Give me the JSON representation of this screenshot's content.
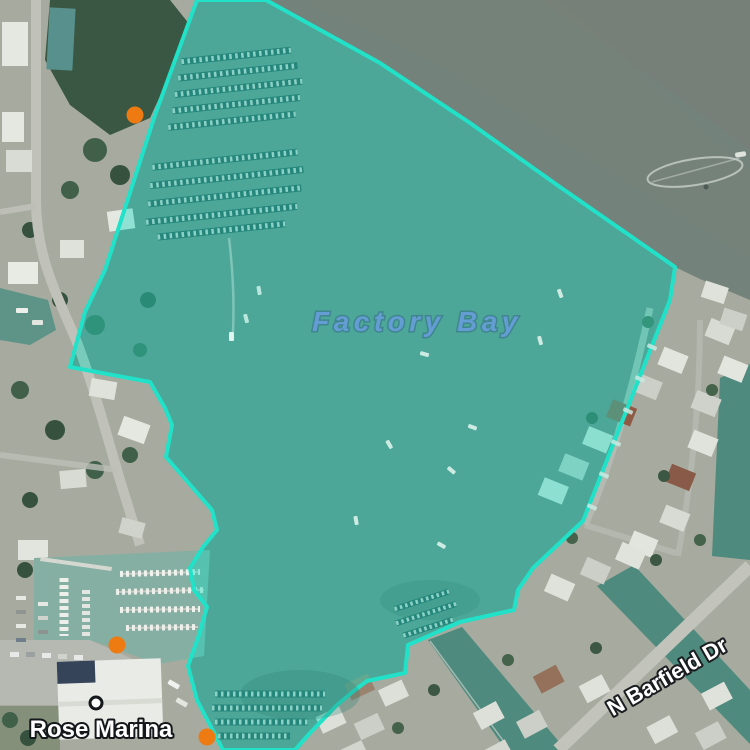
{
  "map": {
    "labels": {
      "water_label": {
        "text": "Factory Bay",
        "x": 417,
        "y": 331,
        "color": "#649DD3"
      },
      "place_label": {
        "text": "Rose Marina",
        "x": 101,
        "y": 737,
        "color": "#FFFFFF"
      },
      "road_label": {
        "text": "N Barfield Dr",
        "x": 667,
        "y": 684,
        "rotation": -30,
        "rx": 667,
        "ry": 676,
        "color": "#FFFFFF"
      }
    },
    "highlight_region": {
      "stroke_color": "#21E2C8",
      "fill_color": "#19DCC2",
      "fill_opacity": 0.42,
      "points": "197,0 266,0 380,63 470,123 560,187 675,267 670,300 583,521 533,568 518,590 514,610 460,622 408,645 405,673 367,681 355,690 337,705 310,733 295,750 223,750 197,700 188,666 199,635 207,607 194,590 190,568 203,547 217,530 212,510 166,457 172,425 165,408 150,382 70,367 85,312 105,270 155,115"
    },
    "markers": {
      "color": "#EE7A12",
      "radius": 8.5,
      "points": [
        {
          "x": 135,
          "y": 115
        },
        {
          "x": 117,
          "y": 645
        },
        {
          "x": 207,
          "y": 737
        }
      ],
      "white_dot": {
        "x": 96,
        "y": 703,
        "radius": 6
      }
    },
    "colors": {
      "open_water": "#73827B",
      "canal_water": "#4E8A7D",
      "marina_water": "#85AFA3",
      "land": "#A6AA9F",
      "road": "#C0C2B9"
    }
  }
}
